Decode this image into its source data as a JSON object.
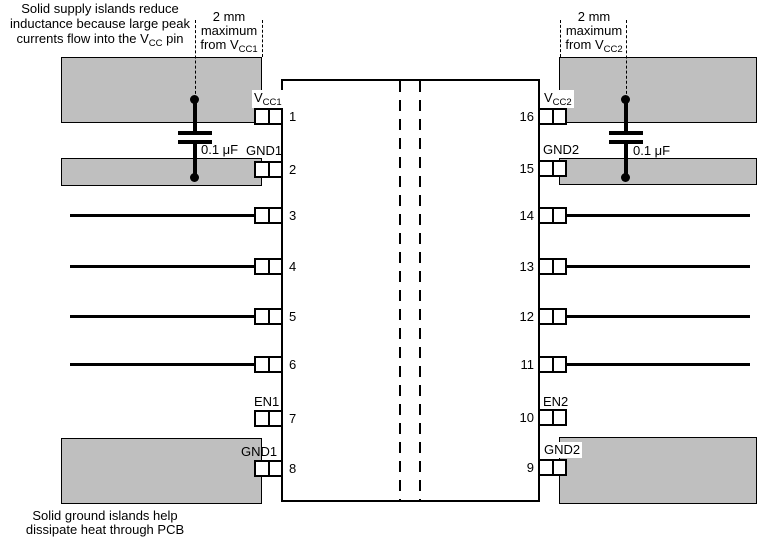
{
  "figure": {
    "type": "pcb-layout-guideline-diagram",
    "description_visible_text_only": true
  },
  "annotations": {
    "supply_note_line1": "Solid supply islands reduce",
    "supply_note_line2": "inductance because large peak",
    "supply_note_line3_pre": "currents flow into the V",
    "supply_note_line3_sub": "CC",
    "supply_note_line3_post": " pin",
    "ground_note_line1": "Solid ground islands help",
    "ground_note_line2": "dissipate heat through PCB",
    "left_distance_line1": "2 mm",
    "left_distance_line2": "maximum",
    "left_distance_line3_pre": "from V",
    "left_distance_line3_sub": "CC1",
    "right_distance_line1": "2 mm",
    "right_distance_line2": "maximum",
    "right_distance_line3_pre": "from V",
    "right_distance_line3_sub": "CC2"
  },
  "capacitors": {
    "left_value": "0.1 μF",
    "right_value": "0.1 μF"
  },
  "pin_numbers": {
    "left": [
      "1",
      "2",
      "3",
      "4",
      "5",
      "6",
      "7",
      "8"
    ],
    "right": [
      "16",
      "15",
      "14",
      "13",
      "12",
      "11",
      "10",
      "9"
    ]
  },
  "pin_labels": {
    "vcc1_main": "V",
    "vcc1_sub": "CC1",
    "gnd1_top": "GND1",
    "en1": "EN1",
    "gnd1_bottom": "GND1",
    "vcc2_main": "V",
    "vcc2_sub": "CC2",
    "gnd2_top": "GND2",
    "en2": "EN2",
    "gnd2_bottom": "GND2"
  },
  "colors": {
    "island_fill": "#bfbfbf",
    "line": "#000000",
    "background": "#ffffff"
  }
}
